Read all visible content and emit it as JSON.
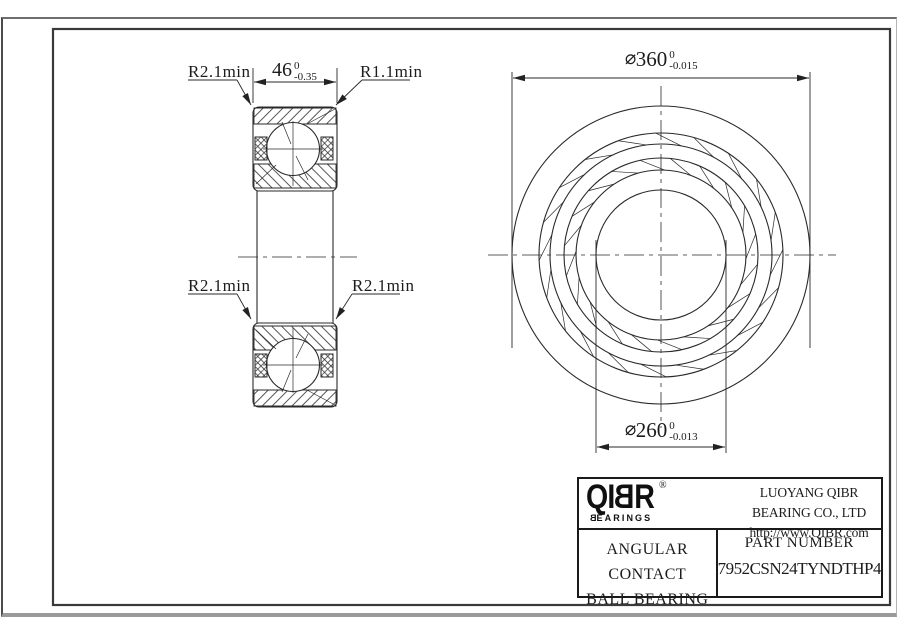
{
  "drawing": {
    "section_view": {
      "label_top_left": "R2.1min",
      "label_top_right": "R1.1min",
      "label_mid_left": "R2.1min",
      "label_mid_right": "R2.1min",
      "width_dim": {
        "value": "46",
        "tol_upper": "0",
        "tol_lower": "-0.35"
      }
    },
    "front_view": {
      "outer_dia": {
        "prefix": "⌀",
        "value": "360",
        "tol_upper": "0",
        "tol_lower": "-0.015"
      },
      "bore_dia": {
        "prefix": "⌀",
        "value": "260",
        "tol_upper": "0",
        "tol_lower": "-0.013"
      }
    }
  },
  "title_block": {
    "logo_text": "QIBR",
    "logo_reg": "®",
    "logo_sub": "BEARINGS",
    "company": "LUOYANG QIBR BEARING CO., LTD",
    "website": "http://www.QIBR.com",
    "product_line1": "ANGULAR CONTACT",
    "product_line2": "BALL BEARING",
    "part_label": "PART NUMBER",
    "part_number": "7952CSN24TYNDTHP4"
  },
  "colors": {
    "line": "#2a2a2a",
    "frame": "#3a3a3a",
    "page_border": "#8a8a8a",
    "background": "#ffffff"
  },
  "geometry": {
    "frame": {
      "x": 53,
      "y": 29,
      "w": 837,
      "h": 576
    },
    "front_view": {
      "cx": 661,
      "cy": 255,
      "circle_radii": [
        149,
        122,
        111,
        97,
        85,
        65
      ],
      "roller_bands": [
        {
          "r_in": 111,
          "r_out": 122,
          "count": 20,
          "offset_deg": 4,
          "skew_deg": 6.5
        },
        {
          "r_in": 85,
          "r_out": 97,
          "count": 20,
          "offset_deg": 13,
          "skew_deg": 7.5
        }
      ],
      "centerline_h": [
        488,
        255,
        836,
        255
      ],
      "centerline_v": [
        661,
        86,
        661,
        428
      ]
    },
    "section_view": {
      "sections": [
        {
          "rect": [
            253,
            107,
            84,
            84
          ],
          "outer_band": [
            [
              254,
              108
            ],
            [
              336,
              108
            ],
            [
              336,
              124
            ],
            [
              254,
              124
            ]
          ],
          "outer_diag": [
            307,
            124,
            335,
            109
          ],
          "inner_band": [
            [
              254,
              164
            ],
            [
              336,
              164
            ],
            [
              336,
              188
            ],
            [
              254,
              188
            ]
          ],
          "inner_diag": [
            256,
            184,
            276,
            165
          ],
          "ball": [
            293,
            149,
            26.5
          ],
          "ball_cross_h": [
            263,
            149,
            323,
            149
          ],
          "ball_cross_v": [
            293,
            121,
            293,
            186
          ],
          "contact": [
            [
              282,
              122,
              291,
              144
            ],
            [
              296,
              156,
              308,
              180
            ]
          ],
          "seals": [
            [
              255,
              137,
              12,
              23
            ],
            [
              321,
              137,
              12,
              23
            ]
          ]
        },
        {
          "rect": [
            253,
            323,
            84,
            84
          ],
          "outer_band": [
            [
              254,
              406
            ],
            [
              336,
              406
            ],
            [
              336,
              390
            ],
            [
              254,
              390
            ]
          ],
          "outer_diag": [
            307,
            390,
            335,
            405
          ],
          "inner_band": [
            [
              254,
              350
            ],
            [
              336,
              350
            ],
            [
              336,
              326
            ],
            [
              254,
              326
            ]
          ],
          "inner_diag": [
            256,
            330,
            276,
            349
          ],
          "ball": [
            293,
            365,
            26.5
          ],
          "ball_cross_h": [
            263,
            365,
            323,
            365
          ],
          "ball_cross_v": [
            293,
            328,
            293,
            393
          ],
          "contact": [
            [
              282,
              392,
              291,
              370
            ],
            [
              296,
              358,
              308,
              334
            ]
          ],
          "seals": [
            [
              255,
              354,
              12,
              23
            ],
            [
              321,
              354,
              12,
              23
            ]
          ]
        }
      ],
      "bore_lines": [
        [
          257,
          191,
          257,
          323
        ],
        [
          333,
          191,
          333,
          323
        ]
      ],
      "centerline": [
        238,
        257,
        357,
        257
      ]
    },
    "dims": {
      "width46": {
        "ext": [
          [
            253,
            68,
            253,
            103
          ],
          [
            337,
            68,
            337,
            103
          ]
        ],
        "line_y": 82,
        "x1": 253,
        "x2": 337,
        "mid": 295
      },
      "dia360": {
        "ext": [
          [
            512,
            72,
            512,
            348
          ],
          [
            810,
            72,
            810,
            348
          ]
        ],
        "line_y": 78,
        "x1": 512,
        "x2": 810,
        "mid": 661
      },
      "dia260": {
        "ext": [
          [
            596,
            240,
            596,
            453
          ],
          [
            726,
            240,
            726,
            453
          ]
        ],
        "line_y": 447,
        "x1": 596,
        "x2": 726,
        "mid": 661
      }
    },
    "leaders": [
      {
        "shoulder": [
          188,
          80,
          237,
          80
        ],
        "diag": [
          237,
          80,
          251,
          105
        ]
      },
      {
        "shoulder": [
          362,
          80,
          410,
          80
        ],
        "diag": [
          362,
          80,
          336,
          105
        ]
      },
      {
        "shoulder": [
          188,
          294,
          237,
          294
        ],
        "diag": [
          237,
          294,
          251,
          319
        ]
      },
      {
        "shoulder": [
          352,
          294,
          400,
          294
        ],
        "diag": [
          352,
          294,
          336,
          319
        ]
      }
    ]
  }
}
